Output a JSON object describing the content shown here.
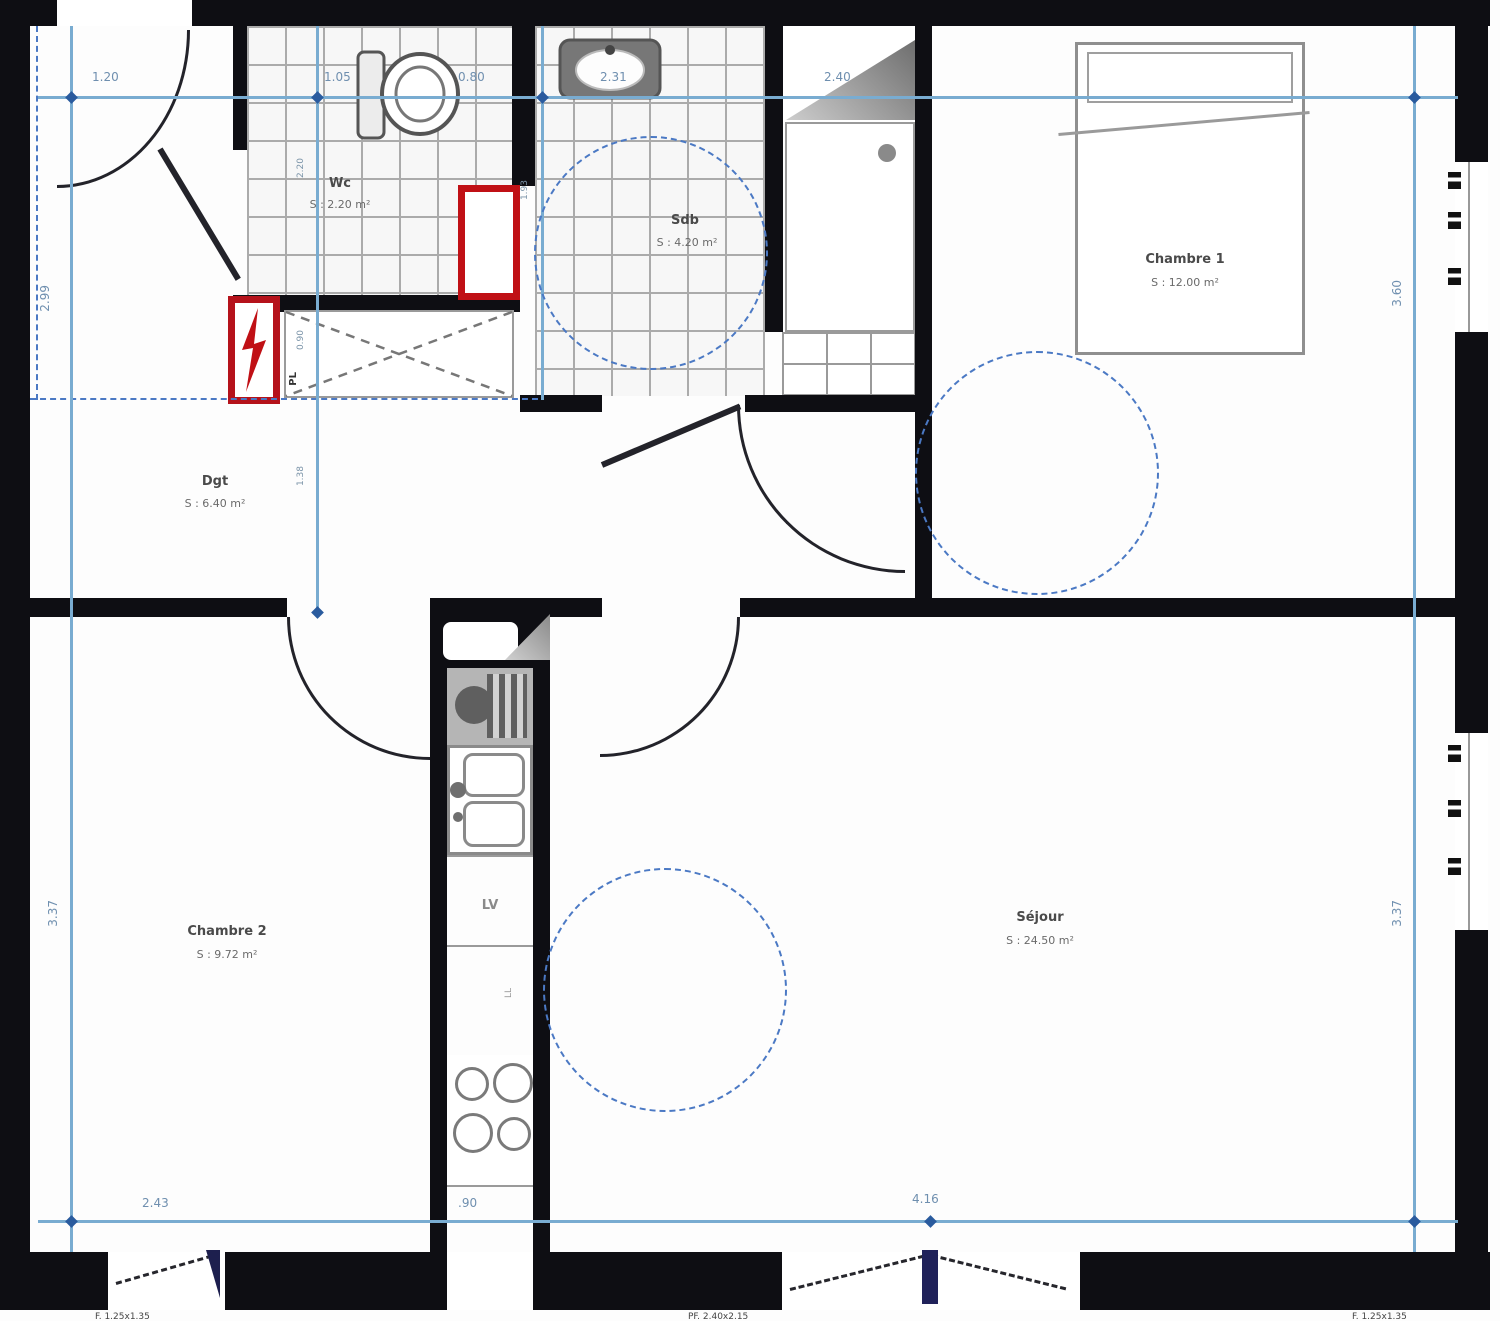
{
  "plan": {
    "rooms": [
      {
        "key": "wc",
        "label": "Wc",
        "area": "S : 2.20 m²"
      },
      {
        "key": "sdb",
        "label": "Sdb",
        "area": "S : 4.20 m²"
      },
      {
        "key": "chambre1",
        "label": "Chambre 1",
        "area": "S : 12.00 m²"
      },
      {
        "key": "degagement",
        "label": "Dgt",
        "area": "S : 6.40 m²"
      },
      {
        "key": "chambre2",
        "label": "Chambre 2",
        "area": "S : 9.72 m²"
      },
      {
        "key": "sejour",
        "label": "Séjour",
        "area": "S : 24.50 m²"
      }
    ],
    "fixtures": {
      "placard": "PL",
      "lave_vaisselle": "LV",
      "lave_linge": "LL"
    },
    "dims": {
      "top": [
        "1.20",
        "1.05",
        "0.80",
        "2.31",
        "2.40"
      ],
      "bottom": [
        "2.43",
        ".90",
        "4.16"
      ],
      "left": [
        "2.99",
        "3.37"
      ],
      "right": [
        "3.60",
        "3.37"
      ],
      "interior": [
        "2.20",
        "0.90",
        "1.38",
        "1.93"
      ]
    },
    "window_specs": [
      "F. 1.25x1.35",
      "PF. 2.40x2.15",
      "F. 1.25x1.35"
    ],
    "colors": {
      "wall": "#0e0e13",
      "dim_line": "#79acd1",
      "dim_dashed": "#4b79c4",
      "marker": "#2a5b9e",
      "accent_red": "#c01015",
      "tile_line": "#a8a8a8",
      "fixture": "#8a8a8a"
    }
  }
}
